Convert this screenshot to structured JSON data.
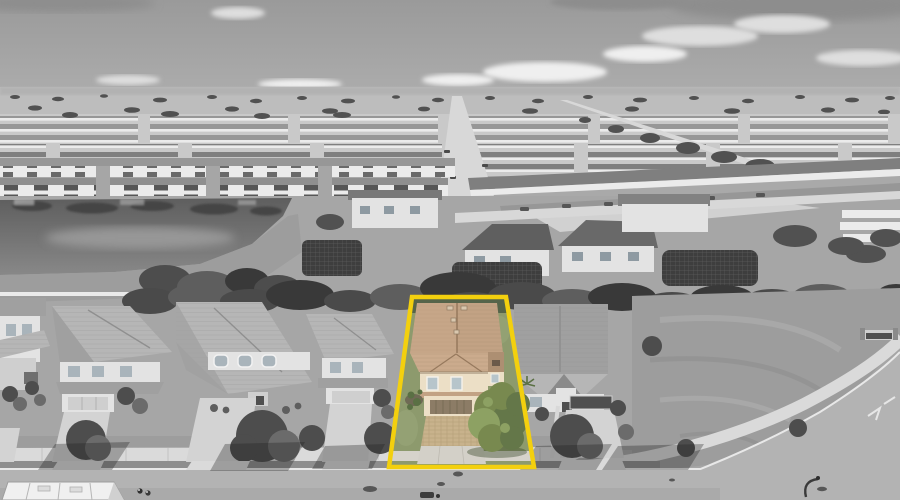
{
  "image": {
    "kind": "aerial-photograph",
    "style": "grayscale-with-selective-color",
    "subject": "single-family-home-highlighted"
  },
  "boundary": {
    "points": "412,297 506,297 534,467 389,467"
  },
  "colors": {
    "skyTop": "#9a9a9a",
    "sky": "#adadad",
    "cloud": "#dedede",
    "cloudBright": "#efefef",
    "cloudDark": "#8d8d8d",
    "field": "#bdbdbd",
    "treeDot": "#515151",
    "devBase": "#c9c9c9",
    "devRoof": "#979797",
    "devRoofDark": "#7f7f7f",
    "devWall": "#ebebeb",
    "road": "#d8d8d8",
    "lakeTop": "#5e5e5e",
    "lakeBottom": "#888888",
    "lakeReflect": "#454545",
    "lakeGleam": "#979797",
    "ground": "#a6a6a6",
    "grass": "#9d9d9d",
    "grassDark": "#8e8e8e",
    "bank": "#b2b2b2",
    "hedge": "#4a4a4a",
    "hedgeLight": "#5e5e5e",
    "hedgeDark": "#393939",
    "cage": "#3e3e3e",
    "cageMesh": "#707070",
    "wall": "#e3e3e3",
    "wallShade": "#cfcfcf",
    "roof": "#b6b6b6",
    "roofShade": "#a0a0a0",
    "roofDark": "#8a8a8a",
    "ridge": "#8f8f8f",
    "window": "#a9b4bb",
    "frame": "#f2f2f2",
    "doorDark": "#4f4f4f",
    "drive": "#d3d3d3",
    "sidewalk": "#dadada",
    "curb": "#e8e8e8",
    "street": "#b3b3b3",
    "streetDark": "#a2a2a2",
    "manhole": "#575757",
    "treeGray": "#4d4d4d",
    "treeGrayLight": "#6b6b6b",
    "shadow": "rgba(30,30,30,0.32)",
    "truck": "#f0f0f0",
    "truckLine": "#b5b5b5",
    "fence": "#eaeaea",
    "yellow": "#f3d00e",
    "lotLawn": "#8d9a6d",
    "lotLawnLight": "#9aa77a",
    "lotHedge": "#55644a",
    "sRoof": "#c2a284",
    "sRoofLight": "#cbab8d",
    "sRoofDark": "#ad8f72",
    "sRidge": "#96795d",
    "sWall": "#ecdfc6",
    "sWindow": "#b7c5cb",
    "sDoor": "#8c7c66",
    "sDoorLine": "#746751",
    "sPaver": "#c8b28c",
    "sPaverLine": "#ab9770",
    "sApron": "#d3d0c8",
    "sWalk": "#d6d3cb",
    "sTree": "#78894f",
    "sTreeDark": "#647749",
    "sTreeLight": "#8da163",
    "sShrub": "#5a7044",
    "sMulch": "#6f6a55",
    "sShadow": "rgba(45,60,30,0.38)"
  }
}
